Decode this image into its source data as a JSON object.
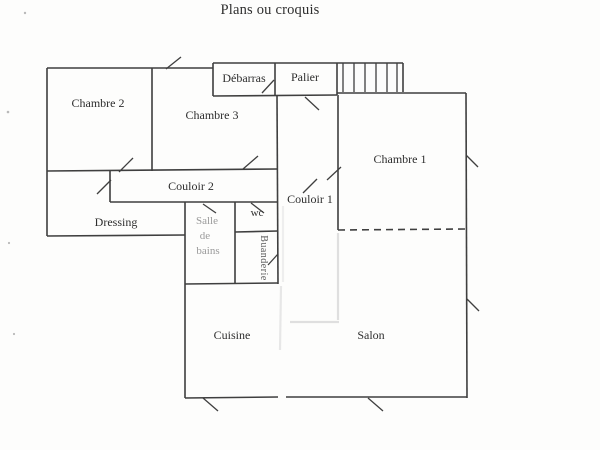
{
  "page": {
    "title": "Plans ou croquis"
  },
  "plan": {
    "rooms": {
      "chambre1": {
        "label": "Chambre 1"
      },
      "chambre2": {
        "label": "Chambre 2"
      },
      "chambre3": {
        "label": "Chambre 3"
      },
      "debarras": {
        "label": "Débarras"
      },
      "palier": {
        "label": "Palier"
      },
      "couloir1": {
        "label": "Couloir 1"
      },
      "couloir2": {
        "label": "Couloir 2"
      },
      "dressing": {
        "label": "Dressing"
      },
      "wc": {
        "label": "wc"
      },
      "salle_de_bains": {
        "line1": "Salle",
        "line2": "de",
        "line3": "bains"
      },
      "buanderie": {
        "label": "Buanderie"
      },
      "cuisine": {
        "label": "Cuisine"
      },
      "salon": {
        "label": "Salon"
      }
    },
    "colors": {
      "ink": "#3f3f3f",
      "faded_text": "#9a9a9a",
      "ghost_artifact": "#dcdcdc",
      "paper": "#fdfdfc"
    }
  }
}
